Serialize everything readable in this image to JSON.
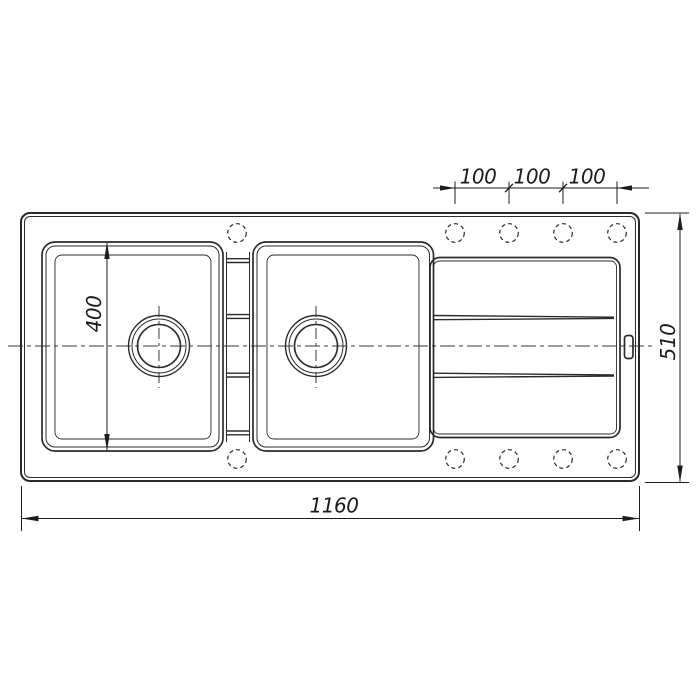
{
  "drawing": {
    "title": "double-bowl-sink-with-drainboard-top-view",
    "colors": {
      "line": "#2b2b28",
      "dim": "#1c1c1c",
      "bg": "#ffffff"
    },
    "dims": {
      "spacing": [
        "100",
        "100",
        "100"
      ],
      "bowl": "400",
      "depth": "510",
      "length": "1160"
    }
  }
}
